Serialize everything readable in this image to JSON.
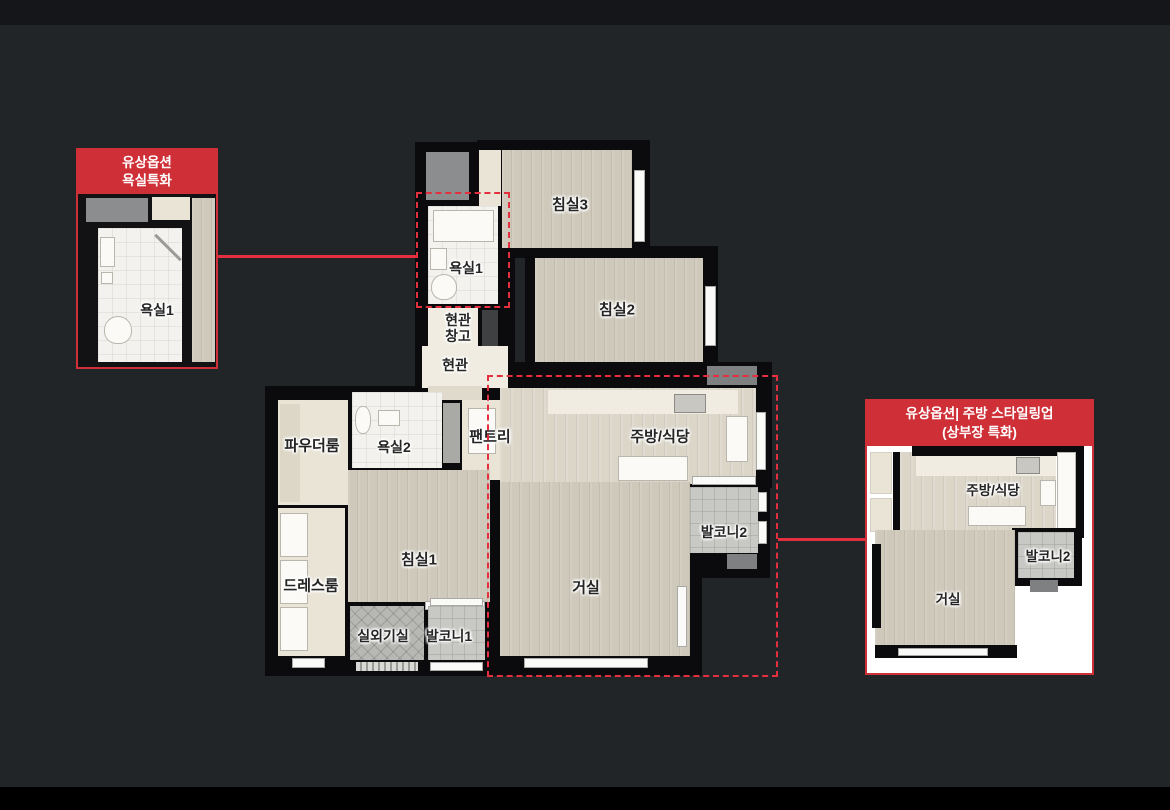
{
  "colors": {
    "accent_red": "#cf3038",
    "dashed_red": "#e4303e",
    "canvas_background": "#212528",
    "top_bar": "#15161a",
    "bottom_bar": "#000000",
    "wall_black": "#0b0b0d",
    "wood_floor": "#cfc9bb",
    "balcony_tile": "#c8c8c4"
  },
  "floor_plan": {
    "rooms": [
      {
        "id": "bedroom3",
        "label": "침실3"
      },
      {
        "id": "bedroom2",
        "label": "침실2"
      },
      {
        "id": "bathroom1",
        "label": "욕실1"
      },
      {
        "id": "entry-storage",
        "label": "현관\n창고"
      },
      {
        "id": "entrance",
        "label": "현관"
      },
      {
        "id": "pantry",
        "label": "팬트리"
      },
      {
        "id": "kitchen",
        "label": "주방/식당"
      },
      {
        "id": "balcony2",
        "label": "발코니2"
      },
      {
        "id": "powder-room",
        "label": "파우더룸"
      },
      {
        "id": "bathroom2",
        "label": "욕실2"
      },
      {
        "id": "bedroom1",
        "label": "침실1"
      },
      {
        "id": "dress-room",
        "label": "드레스룸"
      },
      {
        "id": "outdoor-unit",
        "label": "실외기실"
      },
      {
        "id": "balcony1",
        "label": "발코니1"
      },
      {
        "id": "living-room",
        "label": "거실"
      }
    ]
  },
  "callout_bathroom": {
    "title": "유상옵션\n욕실특화",
    "room_label": "욕실1"
  },
  "callout_kitchen": {
    "title": "유상옵션| 주방 스타일링업\n(상부장 특화)",
    "labels": {
      "kitchen": "주방/식당",
      "balcony": "발코니2",
      "living": "거실"
    }
  }
}
